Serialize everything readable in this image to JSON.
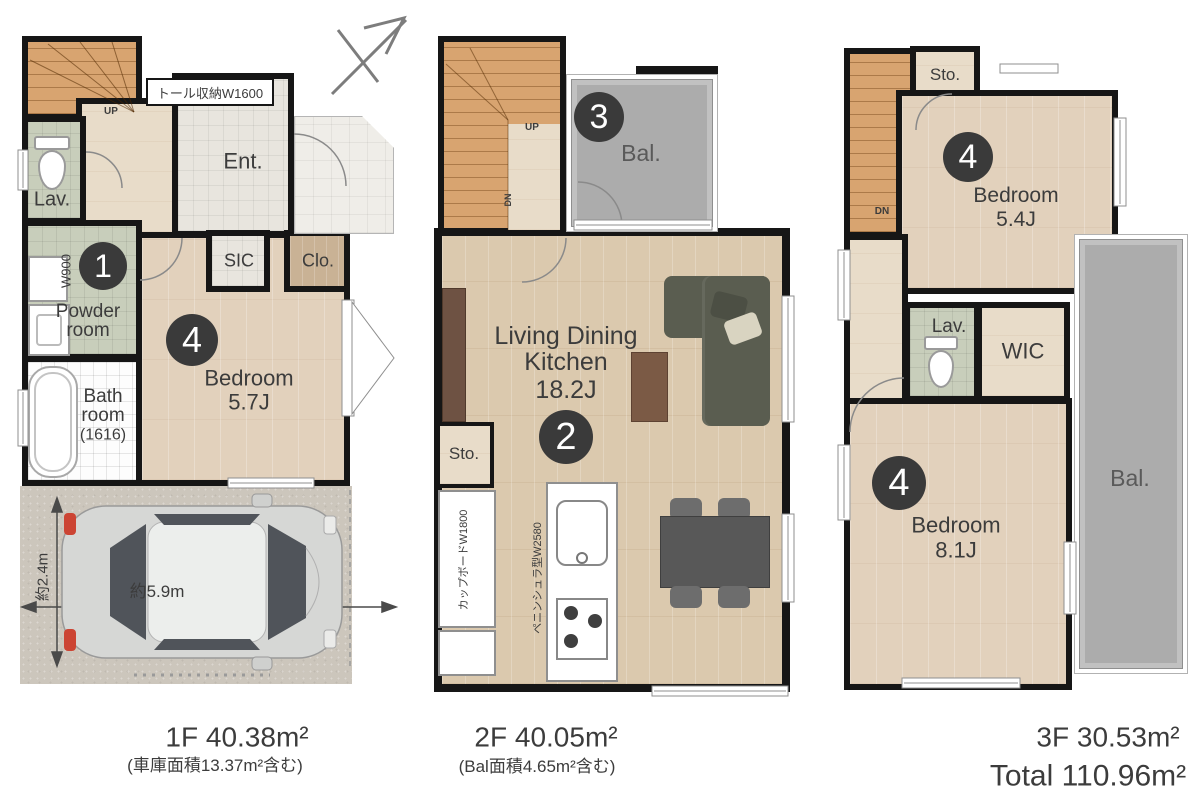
{
  "f1": {
    "stairs_label": "UP",
    "tall_storage_label": "トール収納W1600",
    "entrance_label": "Ent.",
    "lavatory_label": "Lav.",
    "powder_width_label": "W900",
    "powder_number": "1",
    "powder_label_line1": "Powder",
    "powder_label_line2": "room",
    "bath_label_line1": "Bath",
    "bath_label_line2": "room",
    "bath_label_line3": "(1616)",
    "sic_label": "SIC",
    "closet_label": "Clo.",
    "bedroom_number": "4",
    "bedroom_label_line1": "Bedroom",
    "bedroom_label_line2": "5.7J",
    "garage_depth_label": "約2.4m",
    "garage_width_label": "約5.9m",
    "area_label": "1F 40.38m²",
    "area_note": "(車庫面積13.37m²含む)"
  },
  "f2": {
    "stairs_up_label": "UP",
    "stairs_dn_label": "DN",
    "balcony_number": "3",
    "balcony_label": "Bal.",
    "ldk_label_line1": "Living Dining",
    "ldk_label_line2": "Kitchen",
    "ldk_label_line3": "18.2J",
    "ldk_number": "2",
    "storage_label": "Sto.",
    "cupboard_label": "カップボードW1800",
    "kitchen_label": "ペニンシュラ型W2580",
    "area_label": "2F 40.05m²",
    "area_note": "(Bal面積4.65m²含む)"
  },
  "f3": {
    "stairs_dn_label": "DN",
    "storage_label": "Sto.",
    "bedroom1_number": "4",
    "bedroom1_label_line1": "Bedroom",
    "bedroom1_label_line2": "5.4J",
    "lavatory_label": "Lav.",
    "wic_label": "WIC",
    "bedroom2_number": "4",
    "bedroom2_label_line1": "Bedroom",
    "bedroom2_label_line2": "8.1J",
    "balcony_label": "Bal.",
    "area_label": "3F 30.53m²",
    "total_label": "Total 110.96m²"
  }
}
